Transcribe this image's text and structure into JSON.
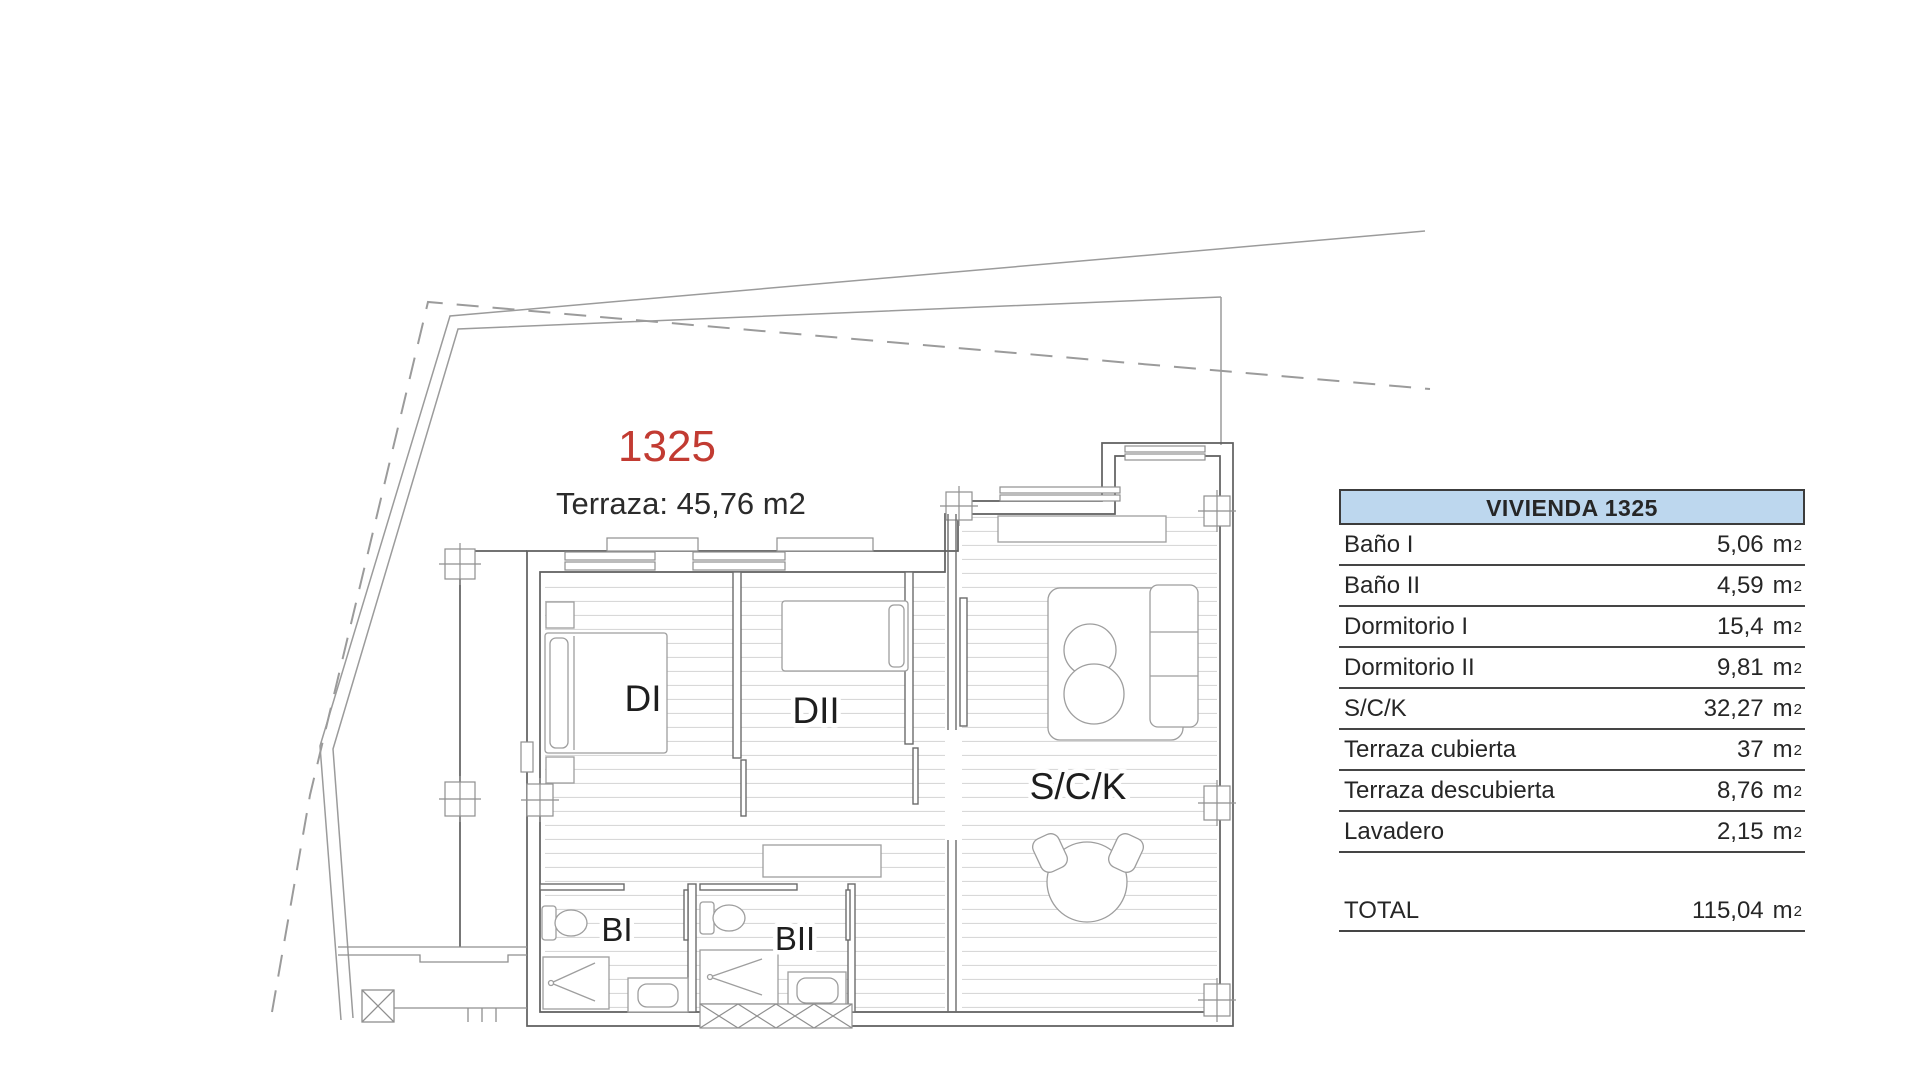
{
  "plan": {
    "unit_number": "1325",
    "unit_number_color": "#c23b32",
    "terrace_note": "Terraza: 45,76 m2",
    "room_labels": {
      "dormitorio1": "DI",
      "dormitorio2": "DII",
      "salon_cocina_kitchen": "S/C/K",
      "bano1": "BI",
      "bano2": "BII"
    }
  },
  "table": {
    "title": "VIVIENDA 1325",
    "header_bg": "#bdd7ee",
    "border_color": "#454545",
    "unit": "m",
    "unit_exponent": "2",
    "rows": [
      {
        "label": "Baño I",
        "value": "5,06"
      },
      {
        "label": "Baño II",
        "value": "4,59"
      },
      {
        "label": "Dormitorio I",
        "value": "15,4"
      },
      {
        "label": "Dormitorio II",
        "value": "9,81"
      },
      {
        "label": "S/C/K",
        "value": "32,27"
      },
      {
        "label": "Terraza cubierta",
        "value": "37"
      },
      {
        "label": "Terraza descubierta",
        "value": "8,76"
      },
      {
        "label": "Lavadero",
        "value": "2,15"
      }
    ],
    "total": {
      "label": "TOTAL",
      "value": "115,04"
    }
  }
}
